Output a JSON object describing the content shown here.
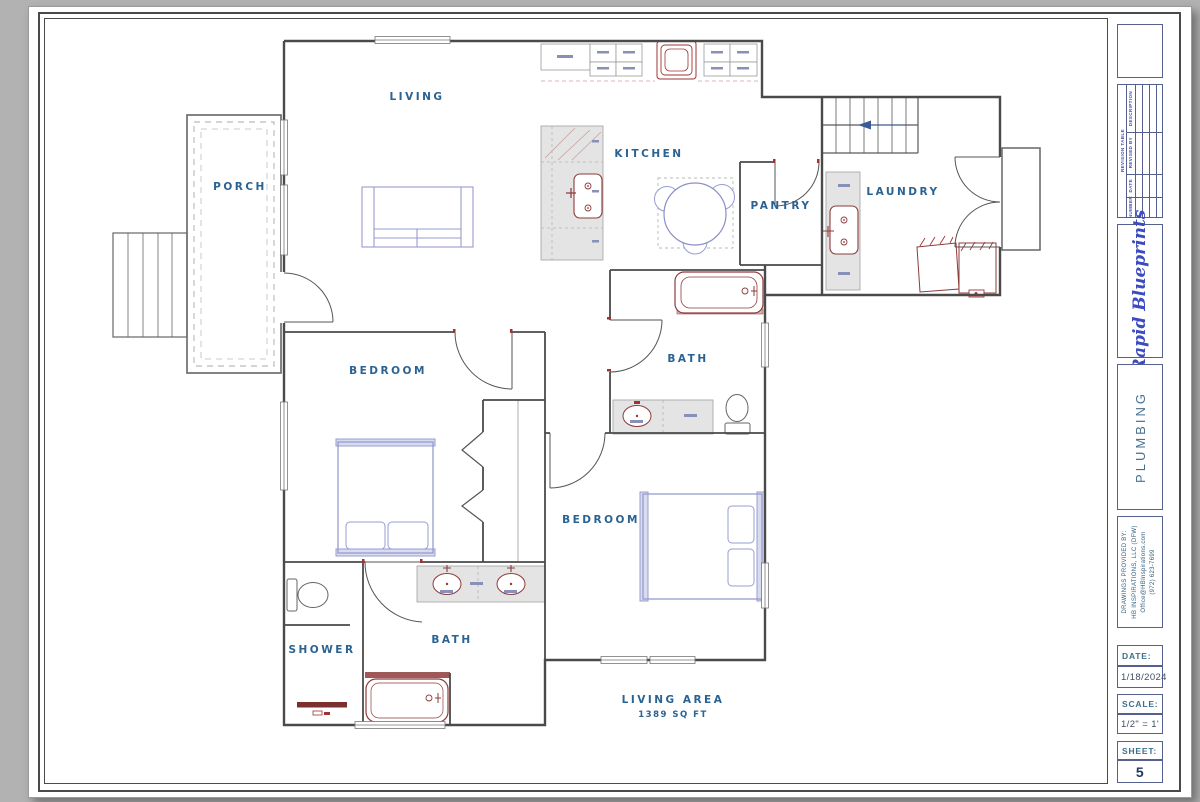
{
  "plan": {
    "rooms": {
      "porch": "PORCH",
      "living": "LIVING",
      "kitchen": "KITCHEN",
      "pantry": "PANTRY",
      "laundry": "LAUNDRY",
      "bath_upper": "BATH",
      "bedroom_left": "BEDROOM",
      "bedroom_lower": "BEDROOM",
      "bath_lower": "BATH",
      "shower": "SHOWER"
    },
    "living_area_label": "LIVING AREA",
    "living_area_value": "1389 SQ FT",
    "colors": {
      "wall": "#4a4a4a",
      "label": "#2a6292",
      "fixture": "#8e3b3b",
      "furniture": "#979ccf",
      "counter": "#e4e4e4"
    }
  },
  "title_block": {
    "revision_table": {
      "title": "REVISION TABLE",
      "columns": [
        "NUMBER",
        "DATE",
        "REVISED BY",
        "DESCRIPTION"
      ]
    },
    "logo_text": "Rapid Blueprints",
    "logo_color": "#3c4cc0",
    "discipline": "PLUMBING",
    "provider": {
      "line1": "DRAWINGS PROVIDED BY:",
      "line2": "HB INSPIRATIONS, LLC (DFW)",
      "line3": "Office@HBInspirations.com",
      "line4": "(972) 623-7699"
    },
    "date": {
      "label": "DATE:",
      "value": "1/18/2024"
    },
    "scale": {
      "label": "SCALE:",
      "value": "1/2\" = 1'"
    },
    "sheet": {
      "label": "SHEET:",
      "value": "5"
    }
  }
}
